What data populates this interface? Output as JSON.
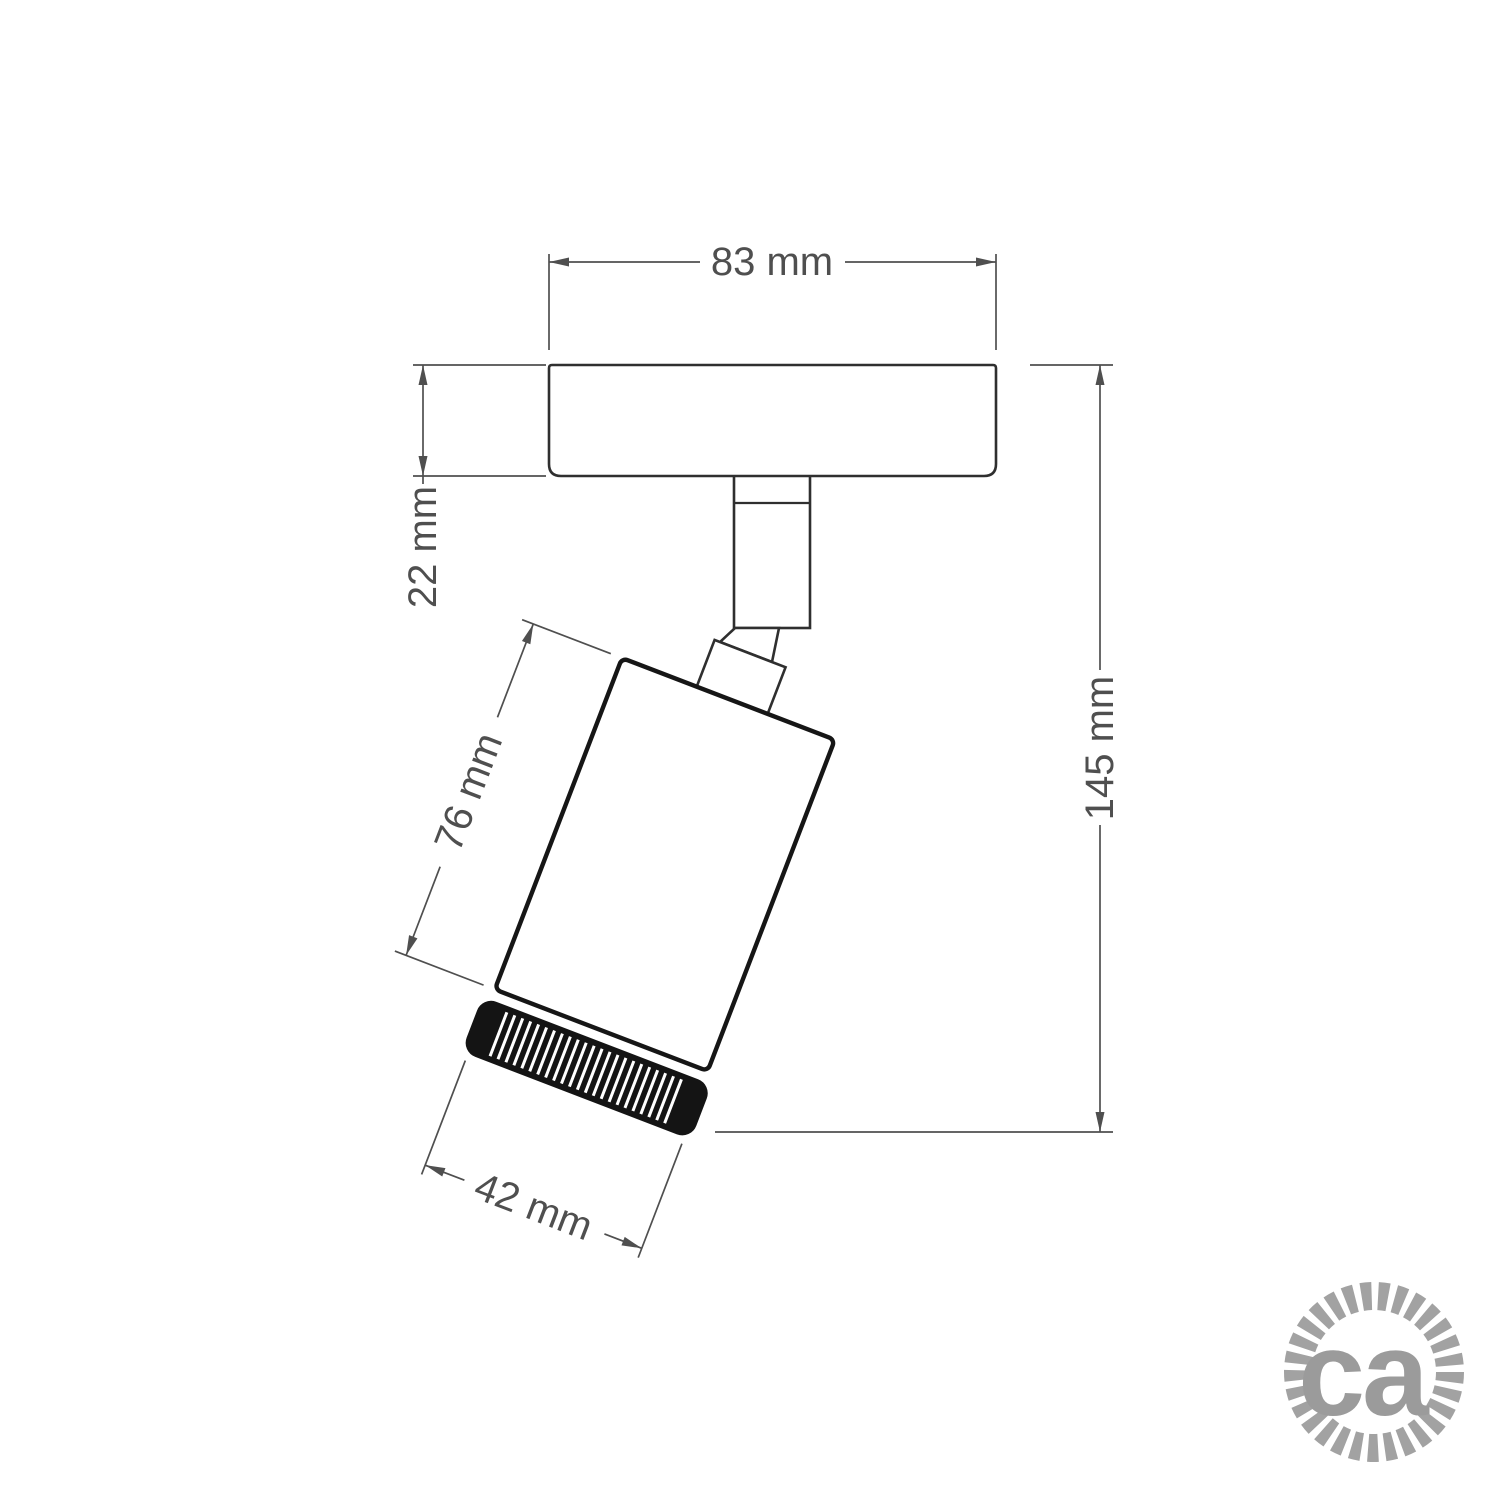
{
  "diagram": {
    "dimensions": {
      "base_width": "83 mm",
      "base_thickness": "22 mm",
      "body_length": "76 mm",
      "total_height": "145 mm",
      "body_diameter": "42 mm"
    },
    "colors": {
      "background": "#ffffff",
      "outline_primary": "#161616",
      "outline_secondary": "#2f2f2f",
      "dimension_lines": "#4f4f4f",
      "logo_gray": "#9b9b9b"
    }
  },
  "logo": {
    "text": "ca"
  }
}
